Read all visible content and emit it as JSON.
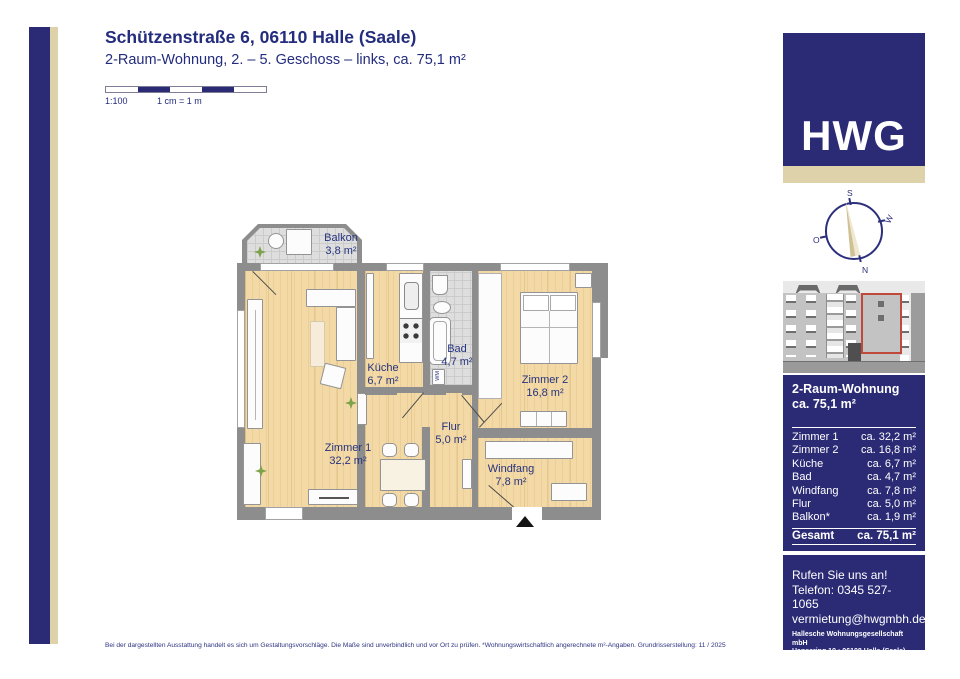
{
  "header": {
    "title": "Schützenstraße 6, 06110 Halle (Saale)",
    "subtitle": "2-Raum-Wohnung, 2. – 5. Geschoss – links, ca. 75,1 m²"
  },
  "scale": {
    "ratio": "1:100",
    "note": "1 cm = 1 m"
  },
  "logo": {
    "text": "HWG"
  },
  "compass": {
    "top": "S",
    "right": "W",
    "left": "O",
    "bottom": "N"
  },
  "plan": {
    "rooms": [
      {
        "name": "Balkon",
        "area": "3,8 m²"
      },
      {
        "name": "Küche",
        "area": "6,7 m²"
      },
      {
        "name": "Bad",
        "area": "4,7 m²"
      },
      {
        "name": "Zimmer 2",
        "area": "16,8 m²"
      },
      {
        "name": "Zimmer 1",
        "area": "32,2 m²"
      },
      {
        "name": "Flur",
        "area": "5,0 m²"
      },
      {
        "name": "Windfang",
        "area": "7,8 m²"
      }
    ],
    "washing_machine_label": "WM"
  },
  "sidebar": {
    "summary": {
      "line1": "2-Raum-Wohnung",
      "line2": "ca. 75,1 m²"
    },
    "table": {
      "rows": [
        {
          "label": "Zimmer 1",
          "value": "ca. 32,2 m²"
        },
        {
          "label": "Zimmer 2",
          "value": "ca. 16,8 m²"
        },
        {
          "label": "Küche",
          "value": "ca. 6,7 m²"
        },
        {
          "label": "Bad",
          "value": "ca. 4,7 m²"
        },
        {
          "label": "Windfang",
          "value": "ca. 7,8 m²"
        },
        {
          "label": "Flur",
          "value": "ca. 5,0 m²"
        },
        {
          "label": "Balkon*",
          "value": "ca. 1,9 m²"
        }
      ],
      "total": {
        "label": "Gesamt",
        "value": "ca. 75,1 m²"
      }
    },
    "contact": {
      "cta": "Rufen Sie uns an!",
      "phone": "Telefon: 0345 527-1065",
      "email": "vermietung@hwgmbh.de",
      "company": "Hallesche Wohnungsgesellschaft mbH",
      "address": "Hansering 19 • 06108 Halle (Saale)",
      "website": "www.hwgmbh.de"
    }
  },
  "footer": {
    "disclaimer": "Bei der dargestellten Ausstattung handelt es sich um Gestaltungsvorschläge. Die Maße sind unverbindlich und vor Ort zu prüfen. *Wohnungswirtschaftlich angerechnete m²-Angaben. Grundrisserstellung: 11 / 2025"
  },
  "colors": {
    "brand_blue": "#2b2a75",
    "accent_beige": "#ddd2a9",
    "highlight_red": "#bf4a3c"
  }
}
